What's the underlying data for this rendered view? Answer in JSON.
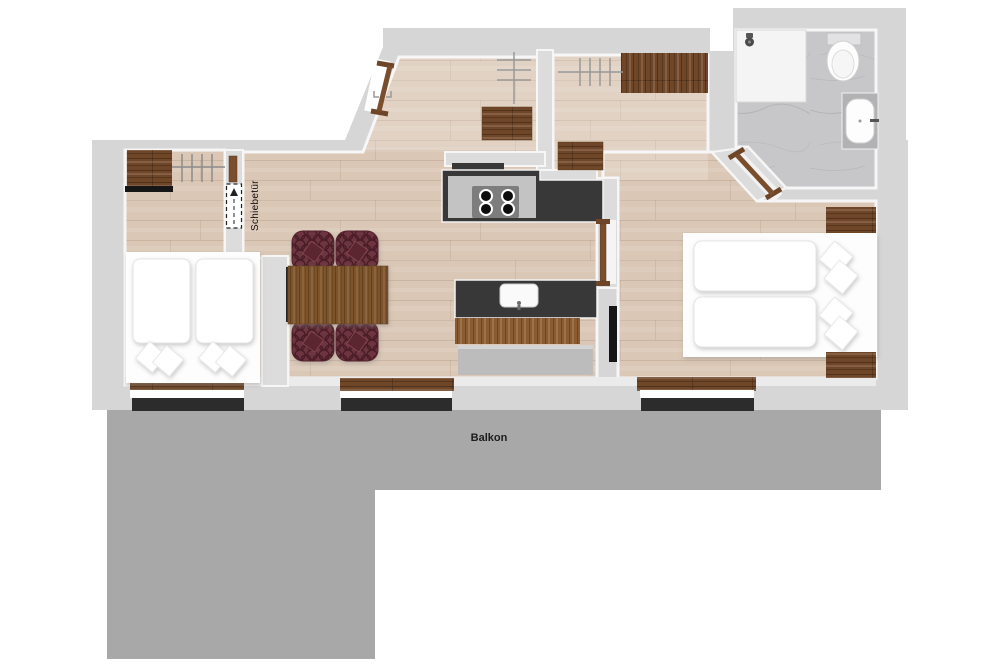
{
  "page": {
    "title": "apartment-floorplan",
    "background": "#ffffff"
  },
  "labels": {
    "sliding_door": "Schiebetür",
    "balcony": "Balkon"
  },
  "colors": {
    "wall": "#d6d6d6",
    "wall_face": "#f6f6f6",
    "floor": "#dac7b5",
    "balcony": "#a8a8a8",
    "dark_wood": "#6f4627",
    "mid_wood": "#8a5c33",
    "counter": "#383838",
    "cooktop": "#c3c3c3",
    "burner_plate": "#7d7d7d",
    "chair": "#6d3541",
    "chair_dark": "#4a1d28",
    "bed": "#ffffff",
    "marble": "#c7c7c9",
    "bench": "#bcbcbc",
    "window_glass": "#2c2c2c",
    "tv": "#151515",
    "door_wood": "#7a4e2c"
  },
  "icons": {
    "shower_head": "shower-head-icon",
    "toilet": "toilet-icon",
    "washbasin": "washbasin-icon",
    "cooktop_burners": "stove-burners-icon",
    "kitchen_sink": "sink-icon",
    "sliding_door_symbol": "sliding-door-dashed-icon",
    "entrance_door": "door-leaf-icon",
    "bathroom_door": "door-leaf-icon",
    "bedroom_door": "door-leaf-icon",
    "window_hatch": "hatch-lines-icon",
    "clothes_rail": "clothes-rail-icon",
    "tv": "tv-screen-icon"
  }
}
